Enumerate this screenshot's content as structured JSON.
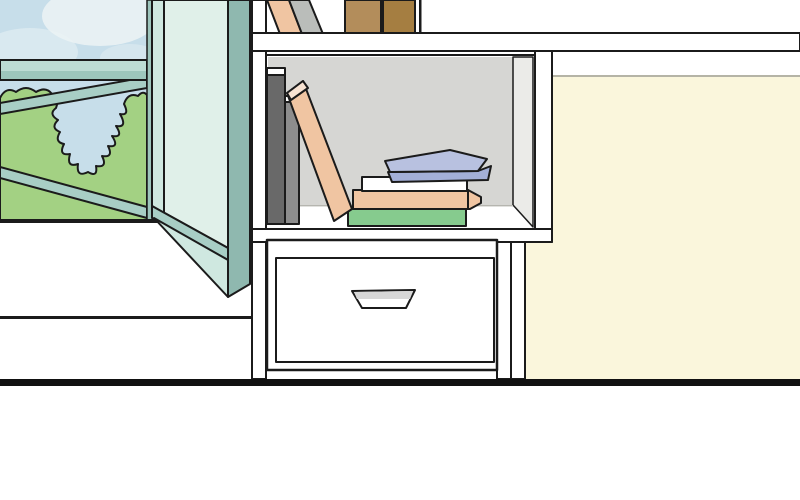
{
  "meta": {
    "kind": "comic-panel-illustration",
    "description": "Cartoon room interior: open casement window with garden view at left, white wall bookshelf with books, white drawer cabinet, cream wall at right, thick black floor line"
  },
  "colors": {
    "outline": "#1b1b1b",
    "wall_white": "#ffffff",
    "wall_cream": "#faf6dc",
    "cream_trim": "#b5b4a6",
    "floor_line": "#111111",
    "sky": "#c7deea",
    "cloud": "#ecf3f5",
    "foliage": "#a3d183",
    "frame_teal_light": "#bddcd4",
    "frame_teal_mid": "#9dc6bc",
    "frame_teal": "#a8cec5",
    "frame_teal_dark": "#9dc5bc",
    "pane_glass": "#e0f0e9",
    "pane_stile": "#cfe8e0",
    "pane_edge": "#8fb8af",
    "shelf_back": "#d6d6d3",
    "shelf_side": "#ebebe8",
    "seam": "#b5b5af",
    "book_dark_gray": "#696969",
    "book_mid_gray": "#8d8d8d",
    "book_light_gray": "#babdba",
    "book_peach": "#f0c5a2",
    "book_peach_light": "#f8e3d2",
    "book_brown_1": "#b38d5b",
    "book_brown_2": "#a57e41",
    "book_blue_top": "#b8c1e0",
    "book_blue_front": "#a3afd7",
    "book_green": "#86cb8e",
    "book_white": "#ffffff",
    "handle_gray": "#d7d7d7"
  },
  "scene": {
    "window": {
      "name": "open casement window",
      "view": [
        "sky",
        "cloud",
        "green bushes"
      ],
      "bars": [
        "horizontal teal bar",
        "upper diagonal bar",
        "lower diagonal bar"
      ],
      "pane": "glass pane opened inward, seen edge-on"
    },
    "bookshelf": {
      "name": "white wall shelf unit",
      "top_shelf_books": [
        "peach leaning book",
        "gray leaning book",
        "light brown upright book",
        "dark brown upright book"
      ],
      "middle_shelf_books": [
        "dark gray upright book",
        "mid gray upright book",
        "peach leaning book",
        "green stacked book",
        "peach stacked book",
        "white stacked book",
        "blue book on top of stack"
      ]
    },
    "drawer": {
      "name": "white drawer cabinet",
      "handle": "recessed trapezoid handle"
    },
    "walls": {
      "left": "white",
      "right": "cream"
    },
    "floor": "thick black baseboard line"
  }
}
